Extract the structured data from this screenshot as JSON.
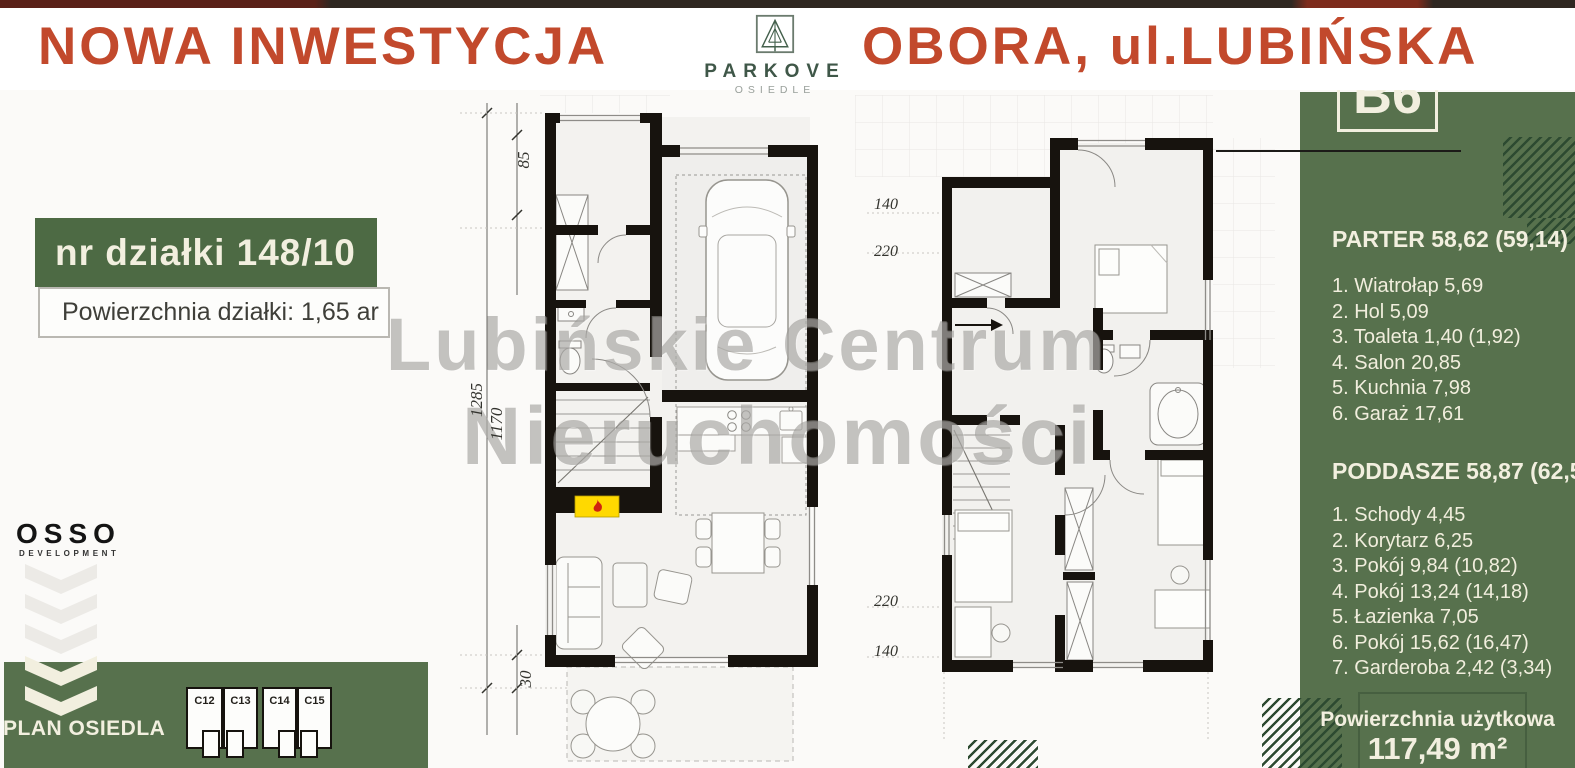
{
  "colors": {
    "accent_red": "#c2492c",
    "panel_green": "#57714d",
    "hatch_green": "#2d4a31",
    "cream": "#f2efdf"
  },
  "header": {
    "left_title": "NOWA INWESTYCJA",
    "right_title": "OBORA, ul.LUBIŃSKA",
    "logo_name": "PARKOVE",
    "logo_sub": "OSIEDLE"
  },
  "unit_badge": "B6",
  "plot_box": {
    "line1": "nr działki 148/10",
    "line2": "Powierzchnia działki:  1,65 ar"
  },
  "developer": {
    "name": "OSSO",
    "sub": "DEVELOPMENT"
  },
  "site_plan": {
    "label": "PLAN OSIEDLA",
    "units": [
      "C12",
      "C13",
      "C14",
      "C15"
    ]
  },
  "watermark": {
    "line1": "Lubińskie Centrum",
    "line2": "Nieruchomości"
  },
  "floor_parter": {
    "title": "PARTER 58,62 (59,14)",
    "rooms": [
      "1. Wiatrołap 5,69",
      "2. Hol 5,09",
      "3. Toaleta 1,40 (1,92)",
      "4. Salon 20,85",
      "5. Kuchnia 7,98",
      "6. Garaż 17,61"
    ]
  },
  "floor_poddasze": {
    "title": "PODDASZE 58,87 (62,56)",
    "rooms": [
      "1. Schody 4,45",
      "2. Korytarz 6,25",
      "3. Pokój 9,84 (10,82)",
      "4. Pokój 13,24 (14,18)",
      "5. Łazienka 7,05",
      "6. Pokój 15,62 (16,47)",
      "7. Garderoba 2,42 (3,34)"
    ]
  },
  "usable_area": {
    "label": "Powierzchnia użytkowa",
    "value": "117,49 m²"
  },
  "dimensions": {
    "plan1_85": "85",
    "plan1_1285": "1285",
    "plan1_1170": "1170",
    "plan1_30": "30",
    "plan2_top_140": "140",
    "plan2_top_220": "220",
    "plan2_bottom_220": "220",
    "plan2_bottom_140": "140"
  },
  "icons": {
    "logo_icon": "pine-tree-in-square",
    "fireplace_icon": "flame",
    "chevrons": "triple-chevron-down"
  }
}
